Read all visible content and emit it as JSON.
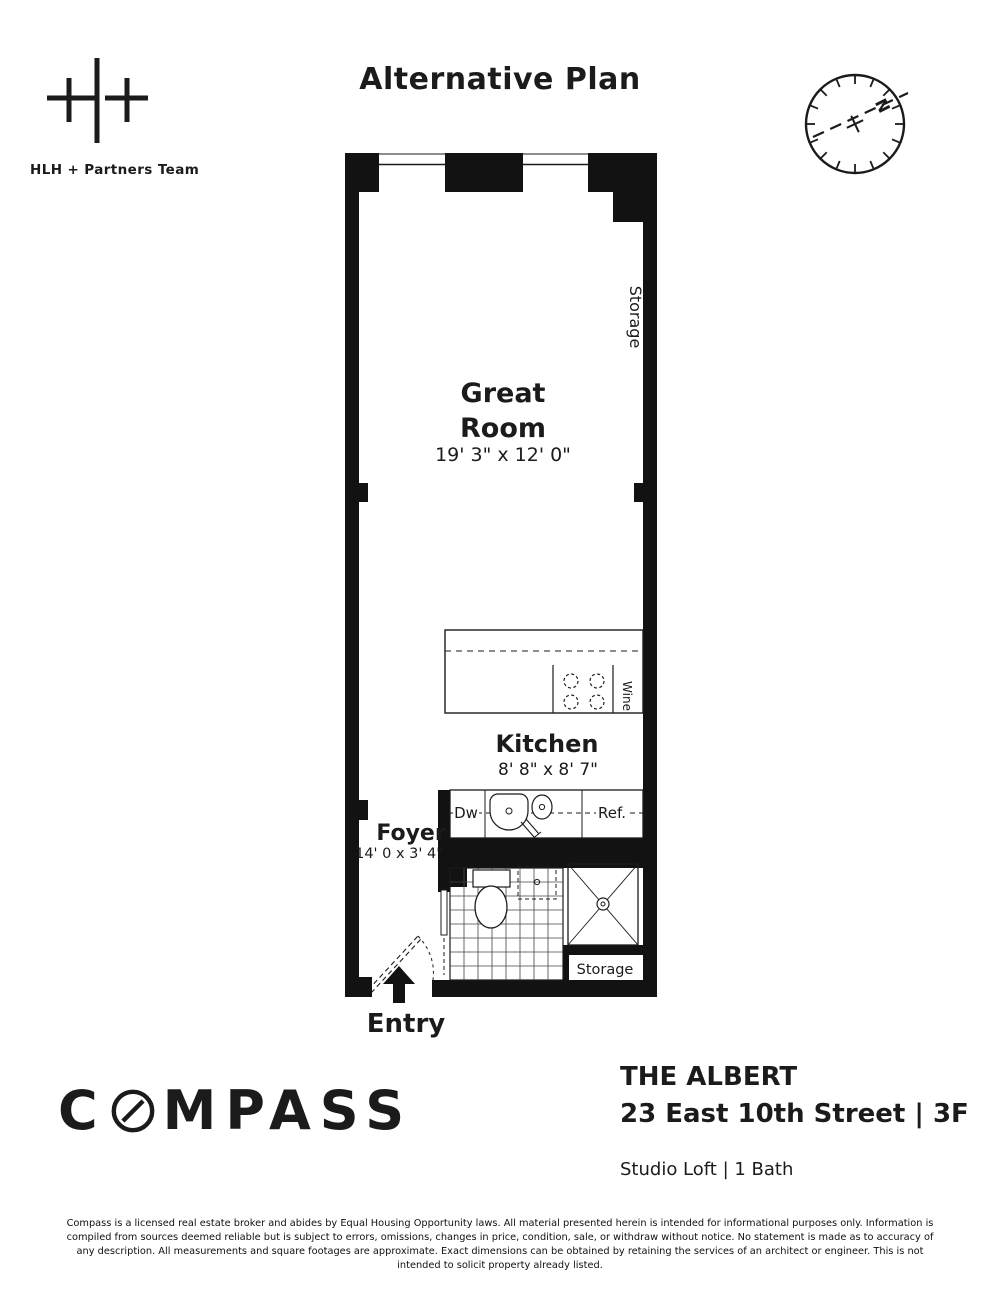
{
  "header": {
    "team_name": "HLH + Partners Team",
    "title": "Alternative Plan",
    "compass_rose": {
      "north_label": "N"
    }
  },
  "floorplan": {
    "great_room": {
      "name_line1": "Great",
      "name_line2": "Room",
      "dimensions": "19' 3\" x 12' 0\""
    },
    "storage_top_label": "Storage",
    "kitchen": {
      "name": "Kitchen",
      "dimensions": "8' 8\" x 8' 7\""
    },
    "wine_label": "Wine",
    "dishwasher_label": "Dw",
    "refrigerator_label": "Ref.",
    "foyer": {
      "name": "Foyer",
      "dimensions": "14' 0 x 3' 4\""
    },
    "storage_bottom_label": "Storage",
    "entry_label": "Entry"
  },
  "footer": {
    "brand": "COMPASS",
    "brand_prefix": "C",
    "brand_suffix": "MPASS",
    "building_name": "THE ALBERT",
    "address": "23 East 10th Street | 3F",
    "unit_info": "Studio Loft | 1 Bath",
    "disclaimer": "Compass is a licensed real estate broker and abides by Equal Housing Opportunity laws. All material presented herein is intended for informational purposes only. Information is compiled from sources deemed reliable but is subject to errors, omissions, changes in price, condition, sale, or withdraw without notice. No statement is made as to accuracy of any description. All measurements and square footages are approximate. Exact dimensions can be obtained by retaining the services of an architect or engineer. This is not intended to solicit property already listed."
  },
  "colors": {
    "ink": "#1b1b1b",
    "background": "#ffffff"
  }
}
